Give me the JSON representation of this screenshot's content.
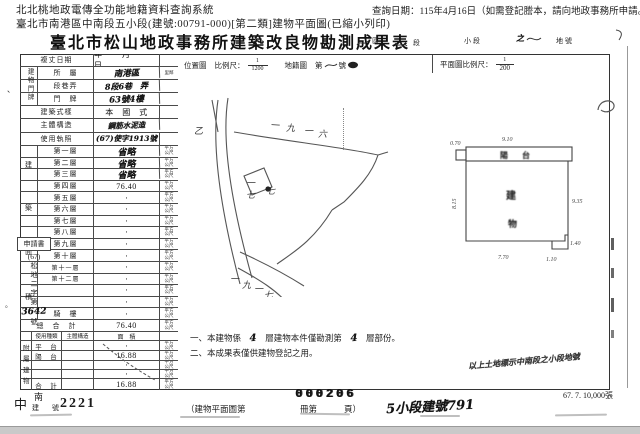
{
  "viewer": {
    "system_title": "北北桃地政電傳全功能地籍資料查詢系統",
    "query_date": "查詢日期：115年4月16日（如需登記謄本，請向地政事務所申請。）",
    "subject_line": "臺北市南港區中南段五小段(建號:00791-000)[第二類]建物平面圖(已縮小列印)"
  },
  "doc": {
    "title": "臺北市松山地政事務所建築改良物勘測成果表",
    "title_suffix": {
      "district": "區",
      "section": "段",
      "subsection": "小段",
      "parcel": "地號",
      "hw_mark": "之"
    }
  },
  "form": {
    "survey_date": {
      "label": "複丈日期",
      "value": "年　月　日"
    },
    "address": {
      "group": "建物門牌",
      "rows": [
        {
          "label": "所　屬",
          "value": "南港區",
          "unit": "里鄰"
        },
        {
          "label": "段巷弄",
          "value": "8段6巷　弄",
          "unit": ""
        },
        {
          "label": "門　牌",
          "value": "63號4樓",
          "unit": ""
        }
      ]
    },
    "style": {
      "label": "建築式樣",
      "value": "本　國　式"
    },
    "structure": {
      "label": "主體構造",
      "value": "鋼筋水泥造"
    },
    "license": {
      "label": "使用執照",
      "value": "(67)使字1913號"
    },
    "area_group_chars": [
      "建",
      "築",
      "面",
      "積"
    ],
    "floors": [
      {
        "label": "第一層",
        "value": "省略"
      },
      {
        "label": "第二層",
        "value": "省略"
      },
      {
        "label": "第三層",
        "value": "省略"
      },
      {
        "label": "第四層",
        "value": "76.40"
      },
      {
        "label": "第五層",
        "value": "·"
      },
      {
        "label": "第六層",
        "value": "·"
      },
      {
        "label": "第七層",
        "value": "·"
      },
      {
        "label": "第八層",
        "value": "·"
      },
      {
        "label": "第九層",
        "value": "·"
      },
      {
        "label": "第十層",
        "value": "·"
      },
      {
        "label": "第十一層",
        "value": "·"
      },
      {
        "label": "第十二層",
        "value": "·"
      },
      {
        "label": "",
        "value": "·"
      },
      {
        "label": "",
        "value": "·"
      },
      {
        "label": "騎　樓",
        "value": "·"
      }
    ],
    "total": {
      "label": "總　合　計",
      "value": "76.40"
    },
    "annex": {
      "group_chars": [
        "附",
        "屬",
        "建",
        "物"
      ],
      "headers": [
        "使用種類",
        "主體構造",
        "面　積"
      ],
      "rows": [
        {
          "label": "平　台",
          "value": "·"
        },
        {
          "label": "陽　台",
          "value": "16.88"
        },
        {
          "label": "",
          "value": "·"
        },
        {
          "label": "",
          "value": "·"
        },
        {
          "label": "合　計",
          "value": "16.88"
        }
      ]
    },
    "unit": "平方公尺"
  },
  "margin_note": {
    "boxed": "申請書",
    "paren": "(67)",
    "vertical": "松地二字第",
    "hw_no": "3642",
    "suffix": "號"
  },
  "location_map": {
    "label": "位置圖",
    "scale_label": "比例尺：",
    "scale_num": "1",
    "scale_den": "1200",
    "cadastral": "地籍圖",
    "sheet_prefix": "第",
    "sheet_suffix": "號",
    "parcel_top": "一九一六",
    "parcel_mid": "一七",
    "parcel_mid2": "七",
    "parcel_bottom": "一九一七",
    "road_mark": "乙"
  },
  "floor_plan": {
    "scale_label": "平面圖比例尺：",
    "scale_num": "1",
    "scale_den": "200",
    "balcony": "陽台",
    "building_char1": "建",
    "building_char2": "物",
    "dims": {
      "top": "9.10",
      "top_left": "0.70",
      "left": "8.15",
      "right": "9.35",
      "bottom": "7.70",
      "notch_w": "1.10",
      "notch_h": "1.40"
    }
  },
  "notes": {
    "n1_pre": "一、本建物係",
    "n1_hw1": "4",
    "n1_mid": "層建物本件僅勘測第",
    "n1_hw2": "4",
    "n1_post": "層部份。",
    "n2": "二、本成果表僅供建物登記之用。",
    "hw_right": "以上土地標示中南段之小段地號"
  },
  "footer": {
    "section_char1": "中",
    "section_char2": "南",
    "reg_label": "建　號",
    "reg_stamp": "2221",
    "serial_stamp": "000206",
    "book1": "（建物平面圖第",
    "book2": "冊第",
    "book3": "頁）",
    "hw_new_no": "5小段建號791",
    "print_info": "67. 7. 10,000張"
  }
}
